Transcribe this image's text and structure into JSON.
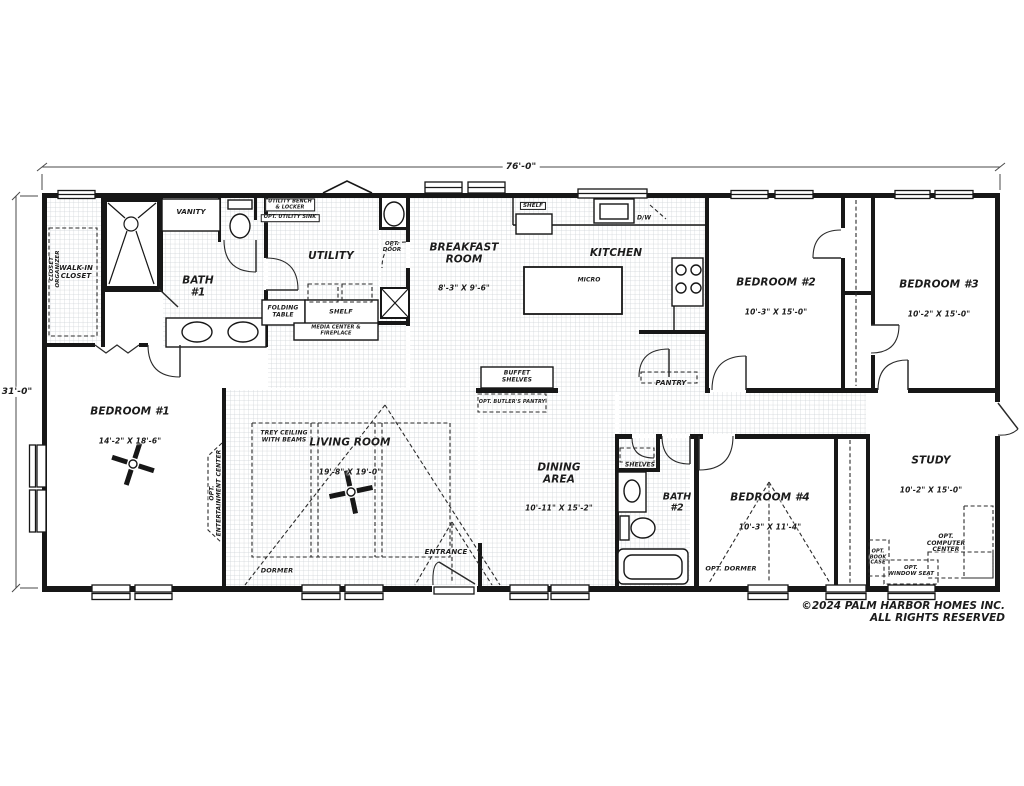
{
  "plan": {
    "width_label": "76'-0\"",
    "height_label": "31'-0\""
  },
  "rooms": {
    "walk_in_closet": {
      "name": "WALK-IN\nCLOSET"
    },
    "bath1": {
      "name": "BATH\n#1"
    },
    "utility": {
      "name": "UTILITY"
    },
    "breakfast": {
      "name": "BREAKFAST\nROOM",
      "dims": "8'-3\" X 9'-6\""
    },
    "kitchen": {
      "name": "KITCHEN"
    },
    "bedroom1": {
      "name": "BEDROOM #1",
      "dims": "14'-2\" X 18'-6\""
    },
    "bedroom2": {
      "name": "BEDROOM #2",
      "dims": "10'-3\" X 15'-0\""
    },
    "bedroom3": {
      "name": "BEDROOM #3",
      "dims": "10'-2\" X 15'-0\""
    },
    "bedroom4": {
      "name": "BEDROOM #4",
      "dims": "10'-3\" X 11'-4\""
    },
    "living": {
      "name": "LIVING ROOM",
      "dims": "19'-8\" X 19'-0\""
    },
    "dining": {
      "name": "DINING\nAREA",
      "dims": "10'-11\" X 15'-2\""
    },
    "bath2": {
      "name": "BATH\n#2"
    },
    "study": {
      "name": "STUDY",
      "dims": "10'-2\" X 15'-0\""
    },
    "pantry": {
      "name": "PANTRY"
    }
  },
  "features": {
    "vanity": "VANITY",
    "closet_organizer": "CLOSET\nORGANIZER",
    "utility_bench": "UTILITY BENCH\n& LOCKER",
    "opt_utility_sink": "OPT. UTILITY SINK",
    "opt_door": "OPT.\nDOOR",
    "folding_table": "FOLDING\nTABLE",
    "shelf_utility": "SHELF",
    "media_center": "MEDIA CENTER &\nFIREPLACE",
    "shelf_kitchen": "SHELF",
    "dishwasher": "D/W",
    "microwave": "MICRO",
    "buffet_shelves": "BUFFET\nSHELVES",
    "opt_butlers_pantry": "OPT. BUTLER'S PANTRY",
    "hall_shelves": "SHELVES",
    "trey_ceiling": "TREY CEILING\nWITH BEAMS",
    "opt_entertainment_center": "OPT.\nENTERTAINMENT CENTER",
    "dormer": "DORMER",
    "entrance": "ENTRANCE",
    "opt_dormer": "OPT. DORMER",
    "opt_computer_center": "OPT.\nCOMPUTER\nCENTER",
    "opt_book_case": "OPT.\nBOOK\nCASE",
    "opt_window_seat": "OPT.\nWINDOW SEAT"
  },
  "footer": {
    "copyright_line1": "©2024 PALM HARBOR HOMES INC.",
    "copyright_line2": "ALL RIGHTS RESERVED"
  },
  "colors": {
    "wall": "#171717",
    "grid": "#ccd1d5",
    "background": "#ffffff",
    "text": "#1c1c1c"
  }
}
